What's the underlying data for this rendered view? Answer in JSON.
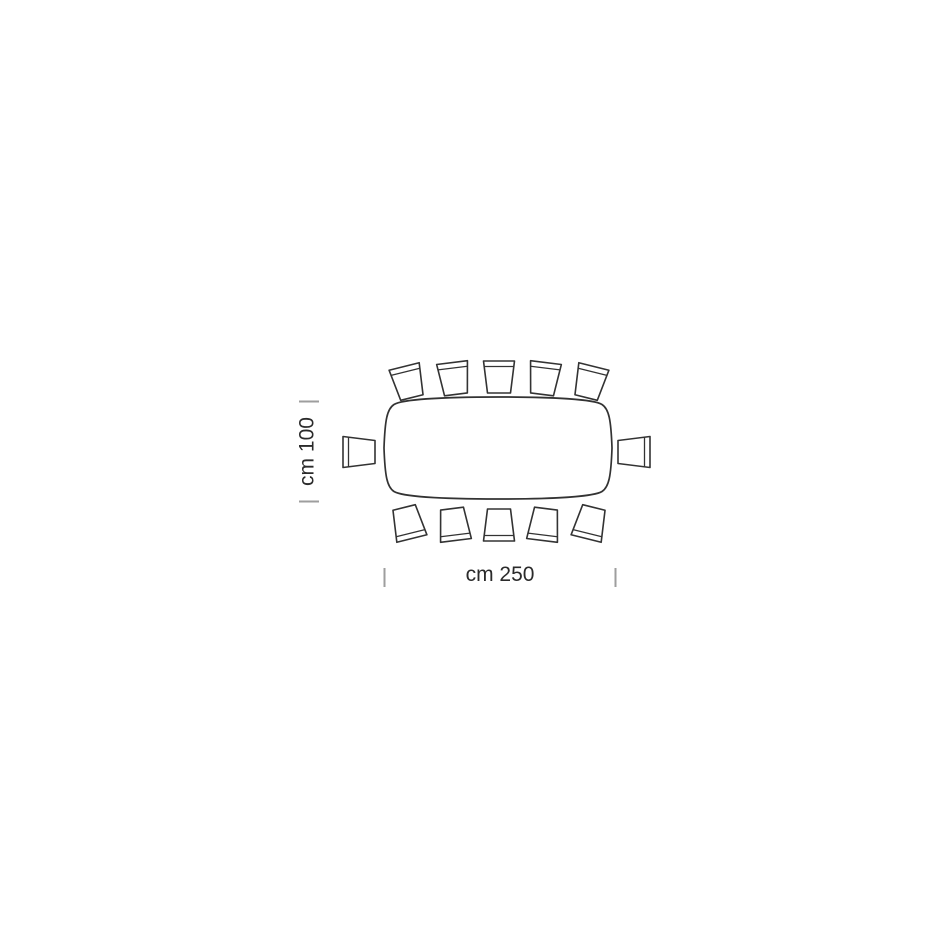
{
  "page": {
    "background_color": "#ffffff"
  },
  "diagram": {
    "kind": "furniture-top-view-dimension-drawing",
    "subject": "oval-barrel dining table with 12 chairs",
    "stroke_color": "#333333",
    "tick_color": "#9e9e9e",
    "label_color": "#2b2b2b",
    "dimensions": {
      "depth": {
        "label": "cm 100",
        "value_cm": 100,
        "axis": "vertical"
      },
      "width": {
        "label": "cm 250",
        "value_cm": 250,
        "axis": "horizontal"
      }
    },
    "table": {
      "x": 384,
      "y": 397,
      "width": 228,
      "height": 102
    },
    "chair_shape": {
      "back_width": 31,
      "seat_width": 23,
      "depth": 32,
      "back_inset": 5.5
    },
    "chairs": [
      {
        "id": "chair-top-1",
        "x": 408,
        "y": 382,
        "angle": -14
      },
      {
        "id": "chair-top-2",
        "x": 454,
        "y": 378.5,
        "angle": -7
      },
      {
        "id": "chair-top-3",
        "x": 499,
        "y": 377,
        "angle": 0
      },
      {
        "id": "chair-top-4",
        "x": 544,
        "y": 378.5,
        "angle": 7
      },
      {
        "id": "chair-top-5",
        "x": 590,
        "y": 382,
        "angle": 14
      },
      {
        "id": "chair-bottom-1",
        "x": 408,
        "y": 523,
        "angle": 166
      },
      {
        "id": "chair-bottom-2",
        "x": 454,
        "y": 524.5,
        "angle": 173
      },
      {
        "id": "chair-bottom-3",
        "x": 499,
        "y": 525,
        "angle": 180
      },
      {
        "id": "chair-bottom-4",
        "x": 544,
        "y": 524.5,
        "angle": 187
      },
      {
        "id": "chair-bottom-5",
        "x": 590,
        "y": 523,
        "angle": 194
      },
      {
        "id": "chair-left",
        "x": 359,
        "y": 452,
        "angle": -90
      },
      {
        "id": "chair-right",
        "x": 634,
        "y": 452,
        "angle": 90
      }
    ],
    "ticks": {
      "depth": [
        {
          "x1": 299,
          "y1": 401.5,
          "x2": 319,
          "y2": 401.5
        },
        {
          "x1": 299,
          "y1": 501.5,
          "x2": 319,
          "y2": 501.5
        }
      ],
      "width": [
        {
          "x1": 384.5,
          "y1": 568,
          "x2": 384.5,
          "y2": 587
        },
        {
          "x1": 615.5,
          "y1": 568,
          "x2": 615.5,
          "y2": 587
        }
      ]
    }
  }
}
